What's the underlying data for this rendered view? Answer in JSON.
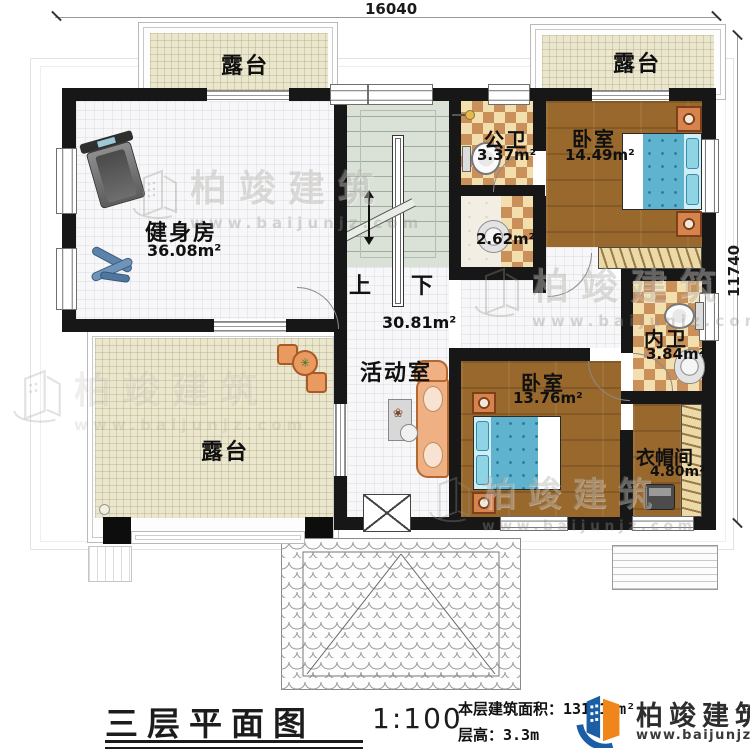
{
  "dimensions": {
    "width_mm": "16040",
    "height_mm": "11740"
  },
  "rooms": {
    "terrace": "露台",
    "gym_name": "健身房",
    "gym_area": "36.08m²",
    "public_bath_name": "公卫",
    "public_bath_area": "3.37m²",
    "wash_area": "2.62m²",
    "bedroom1_name": "卧室",
    "bedroom1_area": "14.49m²",
    "ensuite_name": "内卫",
    "ensuite_area": "3.84m²",
    "activity_name": "活动室",
    "activity_area": "30.81m²",
    "bedroom2_name": "卧室",
    "bedroom2_area": "13.76m²",
    "cloak_name": "衣帽间",
    "cloak_area": "4.80m²"
  },
  "stairs": {
    "up": "上",
    "down": "下"
  },
  "title_block": {
    "plan_title": "三层平面图",
    "scale": "1:100",
    "floor_area": "本层建筑面积：131.10m²",
    "floor_height": "层高：3.3m"
  },
  "brand": {
    "name": "柏竣建筑",
    "website": "www.baijunjz.com",
    "blue": "#1b5ea6",
    "orange": "#f08519"
  },
  "watermark": {
    "name": "柏竣建筑",
    "website": "www.baijunjz.com"
  }
}
